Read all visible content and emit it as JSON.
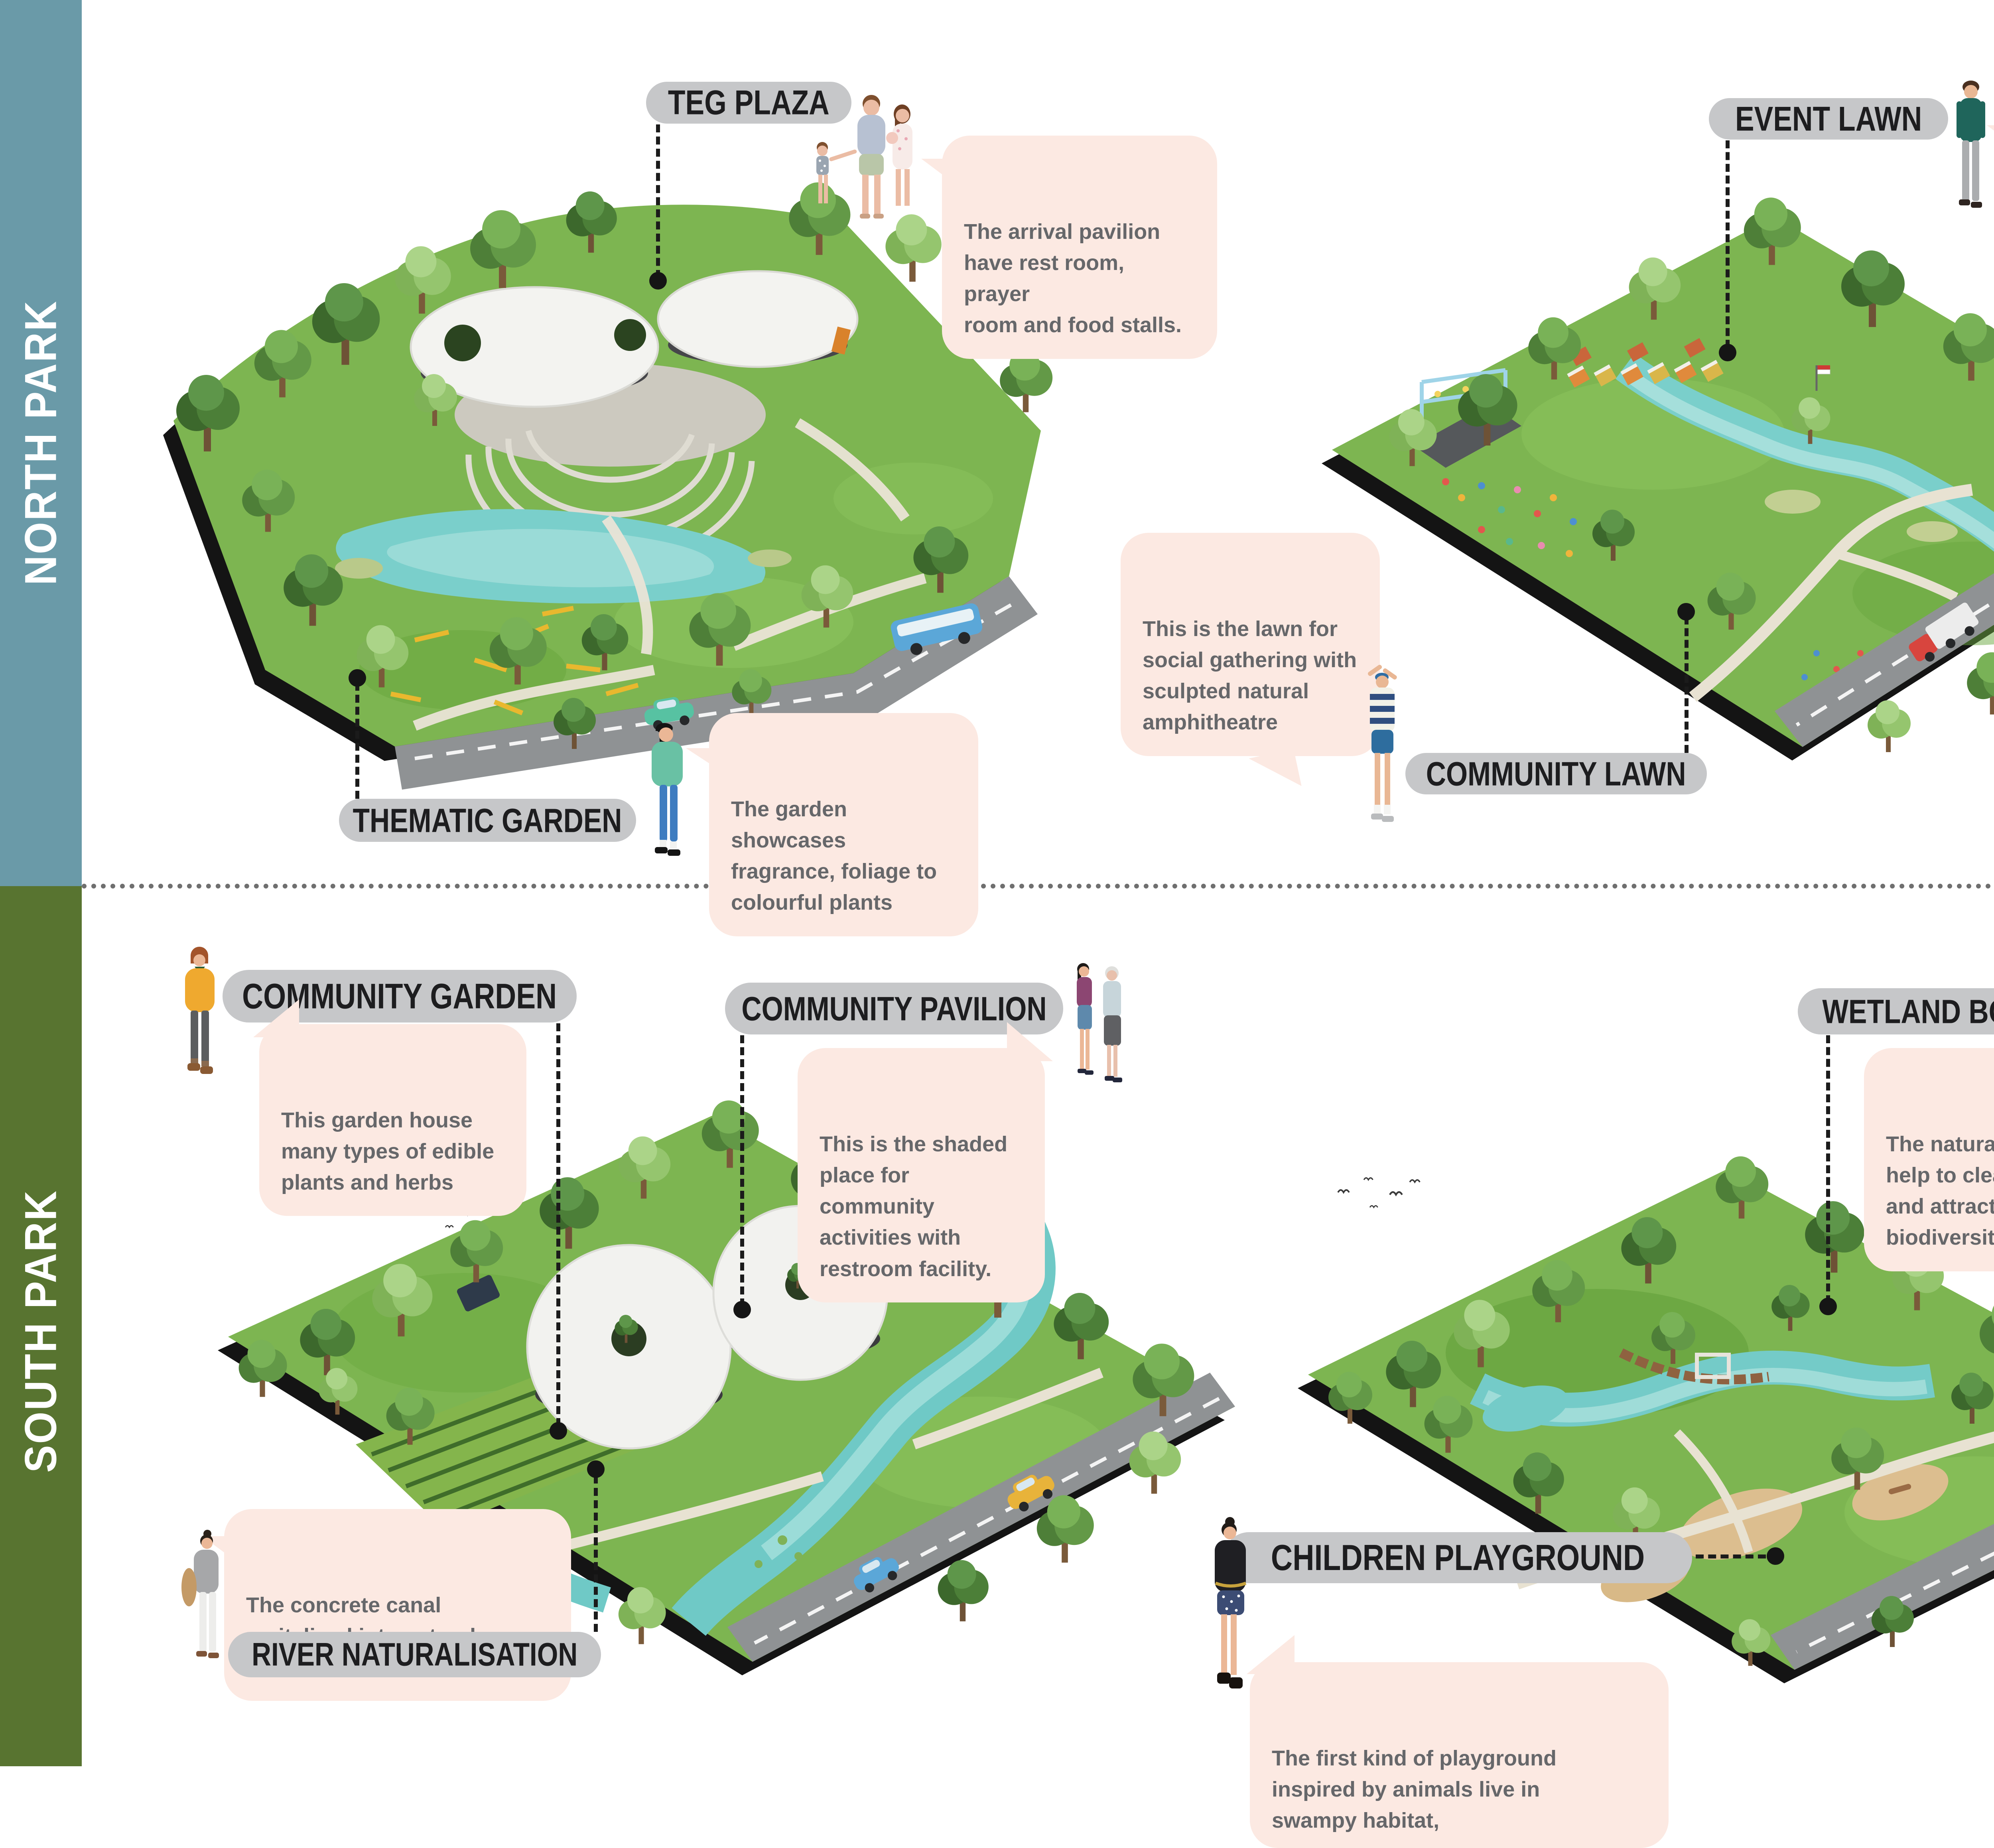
{
  "sidebar": {
    "north": "NORTH PARK",
    "south": "SOUTH PARK"
  },
  "north": {
    "teg_plaza": {
      "label": "TEG PLAZA",
      "callout": "The arrival pavilion\nhave rest room, prayer\nroom and food stalls."
    },
    "event_lawn": {
      "label": "EVENT LAWN",
      "callout": "The former dumping\nsite becomes a place\nfor public events!"
    },
    "thematic_garden": {
      "label": "THEMATIC GARDEN",
      "callout": "The garden showcases\nfragrance, foliage to\ncolourful plants"
    },
    "community_lawn": {
      "label": "COMMUNITY LAWN",
      "callout": "This is the lawn for\nsocial gathering with\nsculpted natural\namphitheatre"
    }
  },
  "south": {
    "community_garden": {
      "label": "COMMUNITY GARDEN",
      "callout": "This garden house\nmany types of edible\nplants and herbs"
    },
    "community_pavilion": {
      "label": "COMMUNITY PAVILION",
      "callout": "This is the shaded\nplace for community\nactivities with\nrestroom facility."
    },
    "river_naturalisation": {
      "label": "RIVER NATURALISATION",
      "callout": "The concrete canal\nrevitalised into natural\nbeautiful river!"
    },
    "wetland_boardwalk": {
      "label": "WETLAND BOARDWALK",
      "callout": "The naturalised drain\nhelp to clean the water\nand attracts\nbiodiversity."
    },
    "children_playground": {
      "label": "CHILDREN PLAYGROUND",
      "callout": "The first kind of playground\ninspired by animals live in\nswampy habitat,"
    }
  },
  "logo": {
    "brand": "TEBET",
    "subtitle": "ECO GARDEN",
    "tagline": "“Connecting People to Nature”"
  },
  "colors": {
    "sidebar_north": "#6A9AA8",
    "sidebar_south": "#587430",
    "label_bg": "#C6C7C9",
    "callout_bg": "#FCE9E2",
    "callout_text": "#66676A",
    "connector": "#1B1B1B",
    "logo_orange": "#E78B3E"
  }
}
